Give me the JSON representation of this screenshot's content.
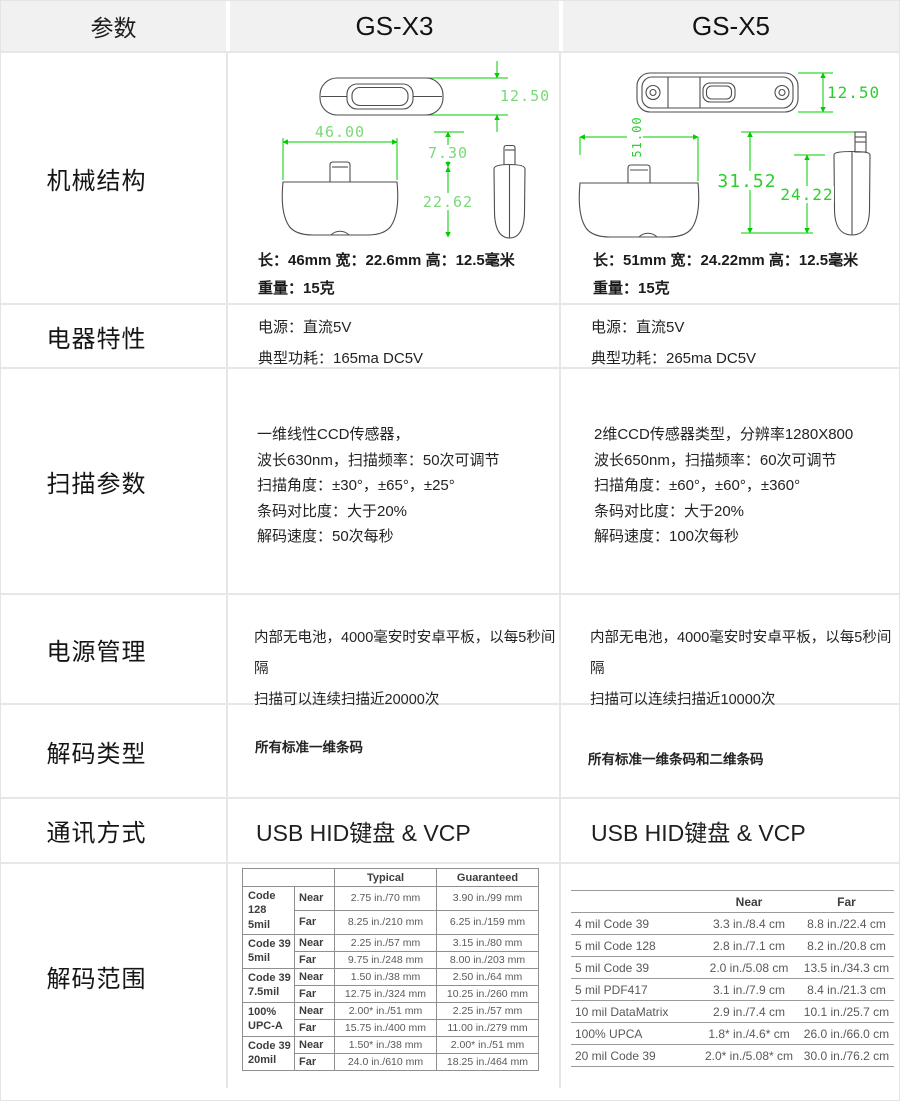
{
  "header": {
    "param": "参数",
    "x3": "GS-X3",
    "x5": "GS-X5"
  },
  "mechanical": {
    "label": "机械结构",
    "x3": {
      "dim_height": "12.50",
      "dim_length": "46.00",
      "dim_plug": "7.30",
      "dim_body": "22.62",
      "size_line": "长：46mm 宽：22.6mm 高：12.5毫米",
      "weight_line": "重量：15克"
    },
    "x5": {
      "dim_height": "12.50",
      "dim_length": "51.00",
      "dim_total": "31.52",
      "dim_body": "24.22",
      "size_line": "长：51mm 宽：24.22mm 高：12.5毫米",
      "weight_line": "重量：15克"
    }
  },
  "electrical": {
    "label": "电器特性",
    "x3": [
      "电源：直流5V",
      "典型功耗：165ma DC5V"
    ],
    "x5": [
      "电源：直流5V",
      "典型功耗：265ma DC5V"
    ]
  },
  "scanning": {
    "label": "扫描参数",
    "x3": [
      "一维线性CCD传感器，",
      "波长630nm，扫描频率：50次可调节",
      "扫描角度：±30°，±65°，±25°",
      "条码对比度：大于20%",
      "解码速度：50次每秒"
    ],
    "x5": [
      "2维CCD传感器类型，分辨率1280X800",
      "波长650nm，扫描频率：60次可调节",
      "扫描角度：±60°，±60°，±360°",
      "条码对比度：大于20%",
      "解码速度：100次每秒"
    ]
  },
  "power": {
    "label": "电源管理",
    "x3": [
      "内部无电池，4000毫安时安卓平板，以每5秒间隔",
      "扫描可以连续扫描近20000次"
    ],
    "x5": [
      "内部无电池，4000毫安时安卓平板，以每5秒间隔",
      "扫描可以连续扫描近10000次"
    ]
  },
  "decode_type": {
    "label": "解码类型",
    "x3": "所有标准一维条码",
    "x5": "所有标准一维条码和二维条码"
  },
  "communication": {
    "label": "通讯方式",
    "x3": "USB HID键盘 & VCP",
    "x5": "USB HID键盘 & VCP"
  },
  "decode_range": {
    "label": "解码范围",
    "x3_table": {
      "col_headers": [
        "Typical",
        "Guaranteed"
      ],
      "near_label": "Near",
      "far_label": "Far",
      "groups": [
        {
          "l1": "Code 128",
          "l2": "5mil",
          "near": [
            "2.75 in./70 mm",
            "3.90 in./99 mm"
          ],
          "far": [
            "8.25 in./210 mm",
            "6.25 in./159 mm"
          ]
        },
        {
          "l1": "Code 39",
          "l2": "5mil",
          "near": [
            "2.25 in./57 mm",
            "3.15 in./80 mm"
          ],
          "far": [
            "9.75 in./248 mm",
            "8.00 in./203 mm"
          ]
        },
        {
          "l1": "Code 39",
          "l2": "7.5mil",
          "near": [
            "1.50 in./38 mm",
            "2.50 in./64 mm"
          ],
          "far": [
            "12.75 in./324 mm",
            "10.25 in./260 mm"
          ]
        },
        {
          "l1": "100%",
          "l2": "UPC-A",
          "near": [
            "2.00* in./51 mm",
            "2.25 in./57 mm"
          ],
          "far": [
            "15.75 in./400 mm",
            "11.00 in./279 mm"
          ]
        },
        {
          "l1": "Code 39",
          "l2": "20mil",
          "near": [
            "1.50* in./38 mm",
            "2.00* in./51 mm"
          ],
          "far": [
            "24.0 in./610 mm",
            "18.25 in./464 mm"
          ]
        }
      ]
    },
    "x5_table": {
      "col_headers": [
        "Near",
        "Far"
      ],
      "rows": [
        {
          "label": "4 mil Code 39",
          "near": "3.3 in./8.4 cm",
          "far": "8.8 in./22.4 cm"
        },
        {
          "label": "5 mil Code 128",
          "near": "2.8 in./7.1 cm",
          "far": "8.2 in./20.8 cm"
        },
        {
          "label": "5 mil Code 39",
          "near": "2.0 in./5.08 cm",
          "far": "13.5 in./34.3 cm"
        },
        {
          "label": "5 mil PDF417",
          "near": "3.1 in./7.9 cm",
          "far": "8.4 in./21.3 cm"
        },
        {
          "label": "10 mil DataMatrix",
          "near": "2.9 in./7.4 cm",
          "far": "10.1 in./25.7 cm"
        },
        {
          "label": "100% UPCA",
          "near": "1.8* in./4.6* cm",
          "far": "26.0 in./66.0 cm"
        },
        {
          "label": "20 mil Code 39",
          "near": "2.0* in./5.08* cm",
          "far": "30.0 in./76.2 cm"
        }
      ]
    }
  },
  "colors": {
    "dim_line_green": "#00cc00",
    "dim_label_green_x3": "#79da79",
    "dim_label_green_x5": "#2fce2f",
    "header_bg": "#f1f1f1",
    "grid_border": "#e7e7e7",
    "table_line": "#8f8f8f"
  }
}
